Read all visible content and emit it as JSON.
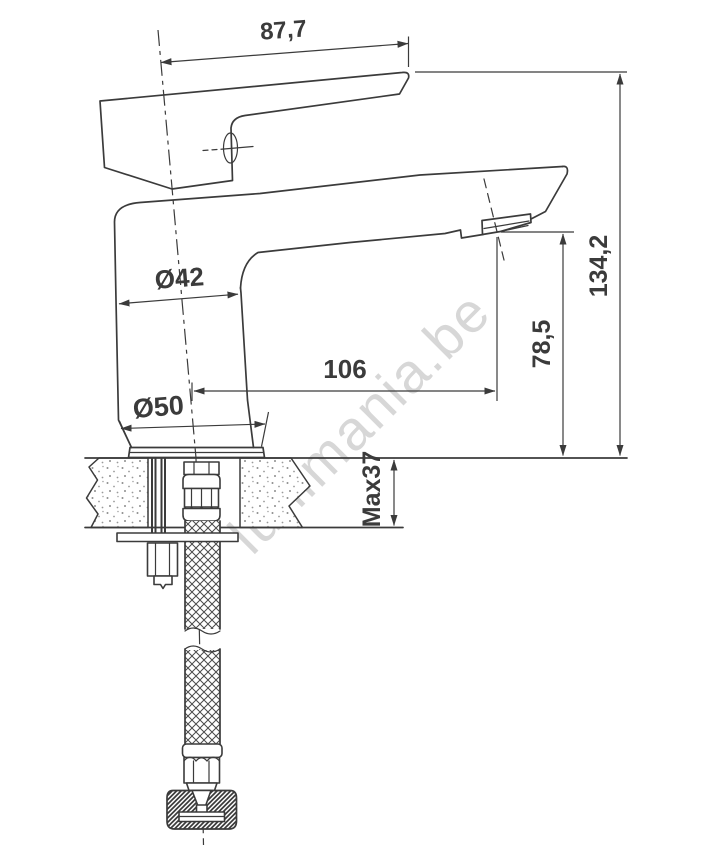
{
  "drawing": {
    "title": "Basin mixer tap technical dimension drawing, side view with deck cross-section",
    "units": "mm",
    "line_color": "#3b3b3b",
    "watermark": {
      "text": "lunimania.be",
      "color": "#d7d7d7"
    },
    "dimensions": {
      "handle_width": {
        "label": "87,7",
        "meaning": "handle / top length"
      },
      "total_height": {
        "label": "134,2",
        "meaning": "overall height above deck"
      },
      "spout_outlet_height": {
        "label": "78,5",
        "meaning": "aerator outlet height above deck"
      },
      "spout_reach": {
        "label": "106",
        "meaning": "spout reach from body axis"
      },
      "body_diameter": {
        "label": "Ø42",
        "meaning": "body diameter"
      },
      "base_diameter": {
        "label": "Ø50",
        "meaning": "base flange diameter"
      },
      "max_deck_thickness": {
        "label": "Max37",
        "meaning": "maximum mounting deck thickness"
      }
    }
  }
}
